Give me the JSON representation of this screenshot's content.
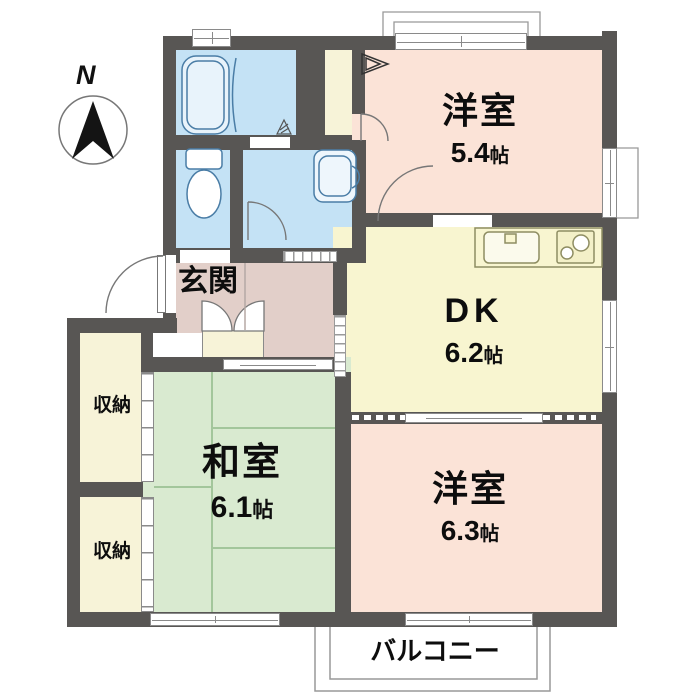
{
  "compass": {
    "label": "N"
  },
  "rooms": {
    "bedroom1": {
      "name": "洋室",
      "size": "5.4",
      "unit": "帖"
    },
    "dk": {
      "name": "DK",
      "size": "6.2",
      "unit": "帖"
    },
    "bedroom2": {
      "name": "洋室",
      "size": "6.3",
      "unit": "帖"
    },
    "washitsu": {
      "name": "和室",
      "size": "6.1",
      "unit": "帖"
    },
    "genkan": {
      "name": "玄関"
    },
    "storage_upper": {
      "name": "収納"
    },
    "storage_lower": {
      "name": "収納"
    },
    "balcony": {
      "name": "バルコニー"
    }
  },
  "fixtures": {
    "bathtub": "bathtub",
    "toilet": "toilet",
    "washbasin": "washbasin",
    "kitchen_sink": "kitchen-sink",
    "stove": "stove",
    "shoe_cabinet": "shoe-cabinet",
    "drain": "drain",
    "closet_shelf": "closet-shelf"
  },
  "colors": {
    "wall": "#585654",
    "western_room": "#fbe3d7",
    "dk": "#f8f5d0",
    "tatami_room": "#d9ead0",
    "hall": "#e2cfc9",
    "wet_area": "#c4e2f5",
    "closet": "#f7f3d8",
    "tatami_line": "#a3c69b",
    "fixture_stroke": "#4a7da6",
    "kitchen_stroke": "#8e8d62",
    "outline": "#999999"
  }
}
